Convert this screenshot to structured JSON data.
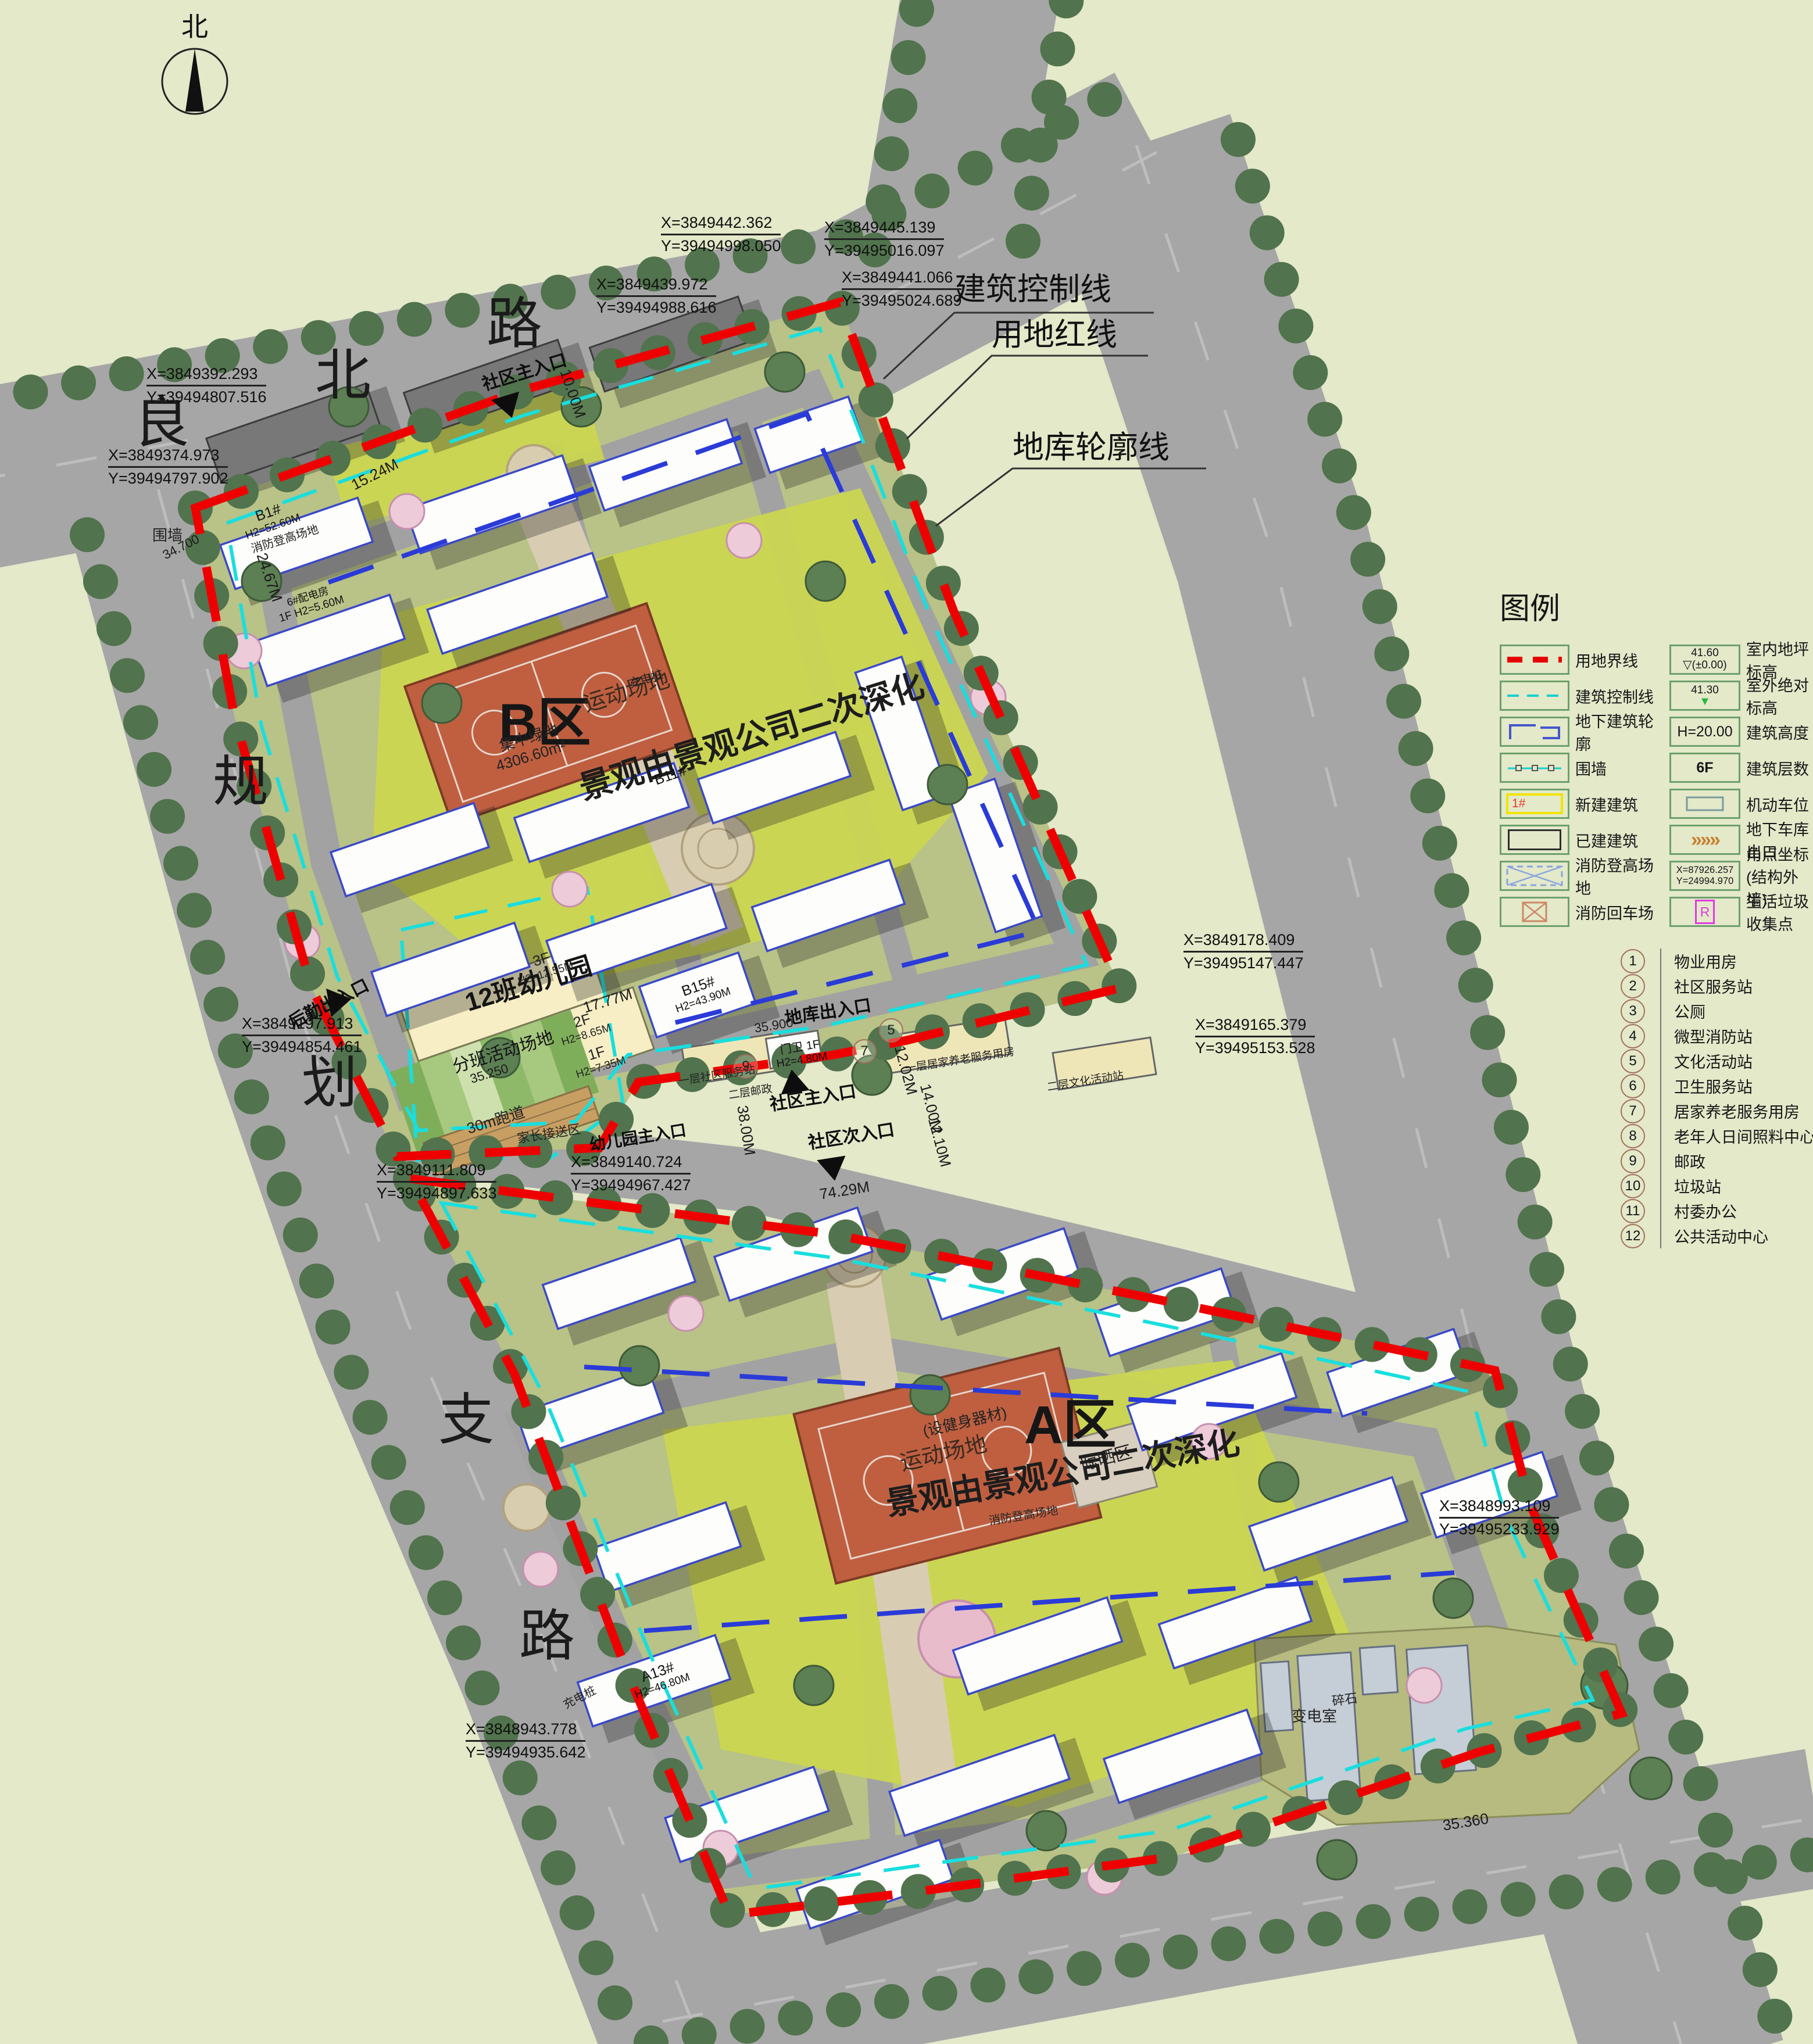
{
  "colors": {
    "boundary_red": "#ee0000",
    "control_cyan": "#19dede",
    "garage_blue": "#2a3bd8",
    "road_gray": "#a6a6a6",
    "field_green": "#e3e9c9",
    "parcel_olive": "#b9c287",
    "lawn_green": "#ccd74f",
    "court_terracotta": "#bf5f40",
    "tree_green": "#51734d"
  },
  "compass": {
    "label": "北"
  },
  "road_names": {
    "north": [
      "良",
      "北",
      "路"
    ],
    "west": [
      "规",
      "划",
      "支",
      "路"
    ]
  },
  "callouts": {
    "control_line": "建筑控制线",
    "red_line": "用地红线",
    "garage_outline": "地库轮廓线"
  },
  "zones": {
    "b": {
      "name": "B区",
      "note": "景观由景观公司二次深化",
      "court": "运动场地",
      "green_label": "集中绿地",
      "green_area": "4306.60m²"
    },
    "a": {
      "name": "A区",
      "note": "景观由景观公司二次深化",
      "court": "运动场地",
      "court_note": "(设健身器材)",
      "drying": "晾晒区"
    },
    "kindergarten": {
      "name": "12班幼儿园",
      "field": "分班活动场地",
      "track": "30m跑道",
      "f3": "3F",
      "f3h": "H2=12.55M",
      "f2": "2F",
      "f2h": "H2=8.65M",
      "f1": "1F",
      "f1h": "H2=7.35M",
      "pickup": "家长接送区"
    },
    "substation": {
      "name": "变电室",
      "gravel": "碎石"
    }
  },
  "buildings": {
    "b1": "B1#",
    "b1h": "H2=52.60M",
    "b11": "B11#",
    "b15": "B15#",
    "b15h": "H2=43.90M",
    "a13": "A13#",
    "a13h": "H2=46.80M",
    "gate": "门卫 1F",
    "gateh": "H2=4.80M",
    "power": "6#配电房",
    "powerh": "1F H2=5.60M"
  },
  "entrances": {
    "north_main": "社区主入口",
    "mid_main": "社区主入口",
    "secondary": "社区次入口",
    "kg_main": "幼儿园主入口",
    "logistics": "后勤出入口",
    "garage": "地库出入口"
  },
  "misc": {
    "wall": "围墙",
    "charging": "充电桩",
    "fire_lane": "消防登高场地"
  },
  "service_strip": {
    "n9": "9",
    "n7": "7",
    "n5": "5",
    "l1": "一层社区服务站",
    "l2": "二层邮政",
    "l3": "一层居家养老服务用房",
    "l4": "二层文化活动站"
  },
  "dims": {
    "d38": "38.00M",
    "d14": "14.00M",
    "d121": "12.10M",
    "d1202": "12.02M",
    "d74": "74.29M",
    "d24": "24.67M",
    "d17": "17.77M",
    "d10": "10.00M",
    "d15": "15.24M",
    "d35": "35.360",
    "e347": "34.700",
    "e359": "35.900",
    "e3525": "35.250"
  },
  "coords": [
    {
      "x": "X=3849442.362",
      "y": "Y=39494998.050"
    },
    {
      "x": "X=3849445.139",
      "y": "Y=39495016.097"
    },
    {
      "x": "X=3849441.066",
      "y": "Y=39495024.689"
    },
    {
      "x": "X=3849439.972",
      "y": "Y=39494988.616"
    },
    {
      "x": "X=3849392.293",
      "y": "Y=39494807.516"
    },
    {
      "x": "X=3849374.973",
      "y": "Y=39494797.902"
    },
    {
      "x": "X=3849197.913",
      "y": "Y=39494854.461"
    },
    {
      "x": "X=3849111.809",
      "y": "Y=39494897.633"
    },
    {
      "x": "X=3849140.724",
      "y": "Y=39494967.427"
    },
    {
      "x": "X=3849178.409",
      "y": "Y=39495147.447"
    },
    {
      "x": "X=3849165.379",
      "y": "Y=39495153.528"
    },
    {
      "x": "X=3848943.778",
      "y": "Y=39494935.642"
    },
    {
      "x": "X=3848993.109",
      "y": "Y=39495233.929"
    }
  ],
  "legend": {
    "title": "图例",
    "left": [
      {
        "label": "用地界线"
      },
      {
        "label": "建筑控制线"
      },
      {
        "label": "地下建筑轮廓"
      },
      {
        "label": "围墙"
      },
      {
        "label": "新建建筑",
        "mark": "1#"
      },
      {
        "label": "已建建筑"
      },
      {
        "label": "消防登高场地"
      },
      {
        "label": "消防回车场"
      }
    ],
    "right": [
      {
        "label": "室内地坪标高",
        "value1": "41.60",
        "value2": "(±0.00)",
        "icon": "▽"
      },
      {
        "label": "室外绝对标高",
        "value1": "41.30",
        "icon": "▼"
      },
      {
        "label": "建筑高度",
        "value1": "H=20.00"
      },
      {
        "label": "建筑层数",
        "value1": "6F"
      },
      {
        "label": "机动车位"
      },
      {
        "label": "地下车库出口",
        "icon": "»»»"
      },
      {
        "label": "角点坐标(结构外墙)",
        "value1": "X=87926.257",
        "value2": "Y=24994.970"
      },
      {
        "label": "生活垃圾收集点",
        "value1": "R"
      }
    ],
    "numbered": [
      {
        "num": "1",
        "label": "物业用房"
      },
      {
        "num": "2",
        "label": "社区服务站"
      },
      {
        "num": "3",
        "label": "公厕"
      },
      {
        "num": "4",
        "label": "微型消防站"
      },
      {
        "num": "5",
        "label": "文化活动站"
      },
      {
        "num": "6",
        "label": "卫生服务站"
      },
      {
        "num": "7",
        "label": "居家养老服务用房"
      },
      {
        "num": "8",
        "label": "老年人日间照料中心"
      },
      {
        "num": "9",
        "label": "邮政"
      },
      {
        "num": "10",
        "label": "垃圾站"
      },
      {
        "num": "11",
        "label": "村委办公"
      },
      {
        "num": "12",
        "label": "公共活动中心"
      }
    ]
  }
}
